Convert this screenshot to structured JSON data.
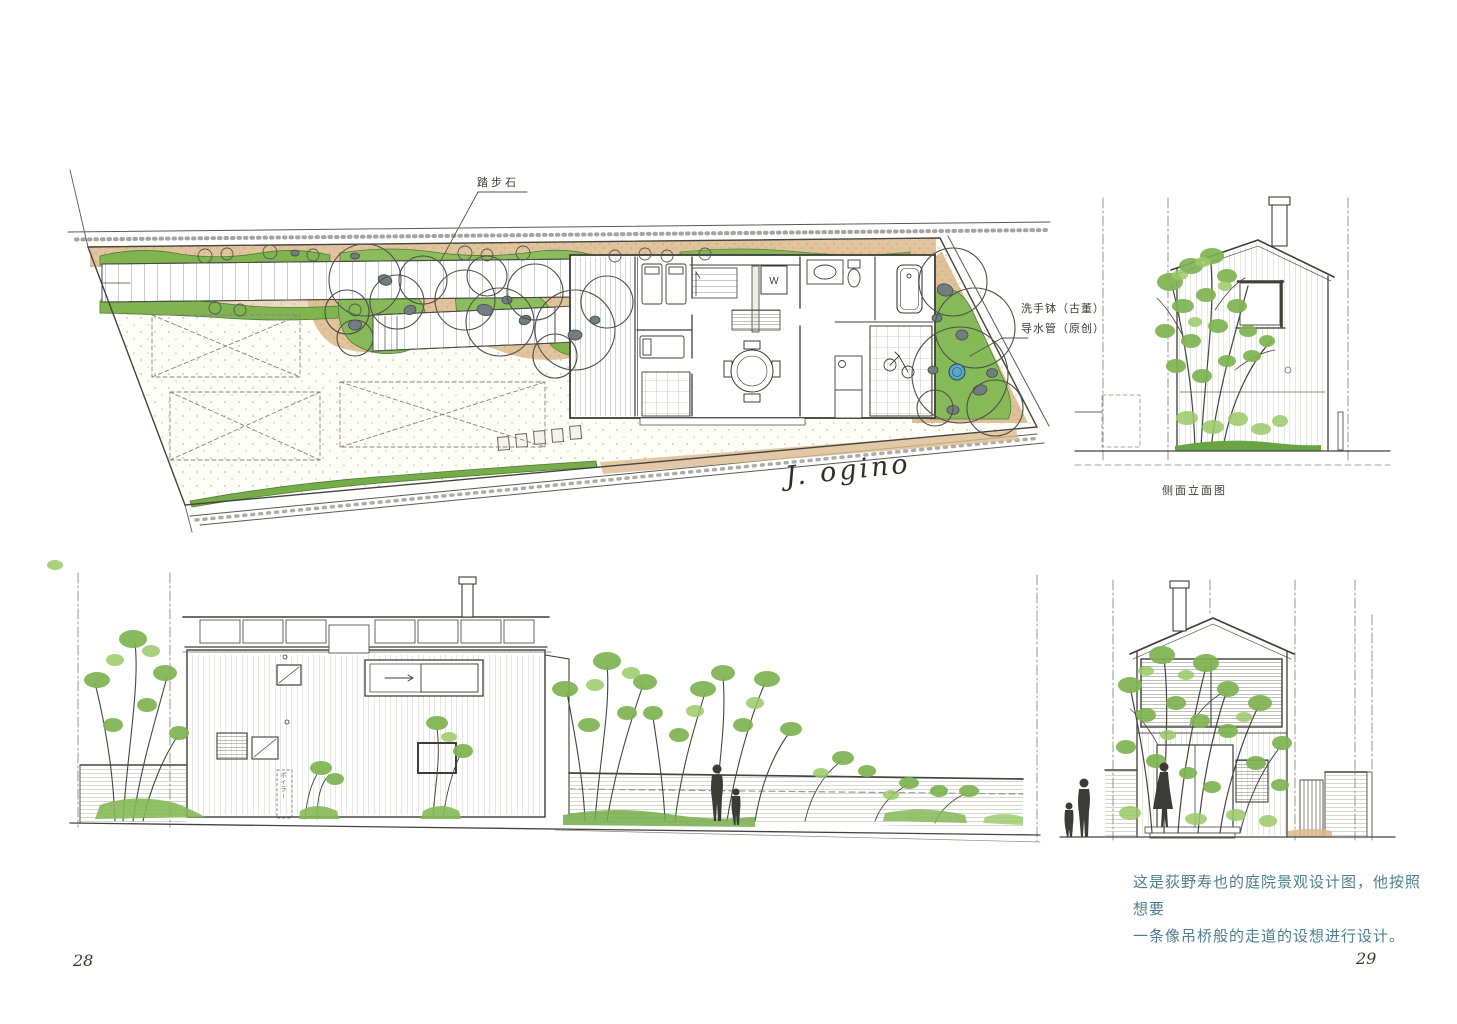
{
  "page": {
    "left_number": "28",
    "right_number": "29"
  },
  "site_plan": {
    "stepping_stone_label": "踏步石",
    "washbasin_label": "洗手钵（古董）",
    "water_pipe_label": "导水管（原创）",
    "washer_label": "W",
    "signature": "J. ogino"
  },
  "side_elevation": {
    "caption": "侧面立面图"
  },
  "long_elevation": {
    "boiler_label": "ボイラー"
  },
  "caption": {
    "line1": "这是荻野寿也的庭院景观设计图，他按照想要",
    "line2": "一条像吊桥般的走道的设想进行设计。"
  },
  "colors": {
    "caption_text": "#4e7e90",
    "foliage_green": "#7fb451",
    "foliage_light": "#9cc968",
    "soil_tan": "#dcba8e",
    "basin_blue": "#5aa9ca",
    "rock_gray": "#737c7e",
    "ink": "#4a4a44"
  }
}
